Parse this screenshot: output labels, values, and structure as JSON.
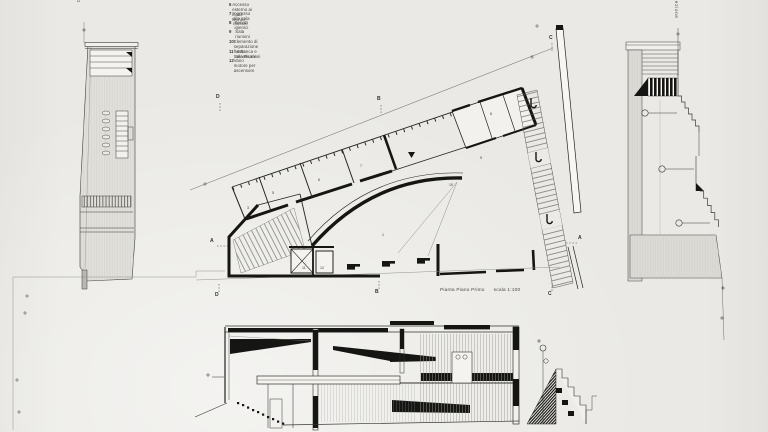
{
  "sheet": {
    "paper_color": "#e9e8e4",
    "ink_color": "#1d1d1b",
    "gray_fill": "#deddd8"
  },
  "legend": {
    "items": [
      {
        "num": "6",
        "text": "Accesso esterno ai locali tecnici"
      },
      {
        "num": "7",
        "text": "Ingresso alla sala riunioni"
      },
      {
        "num": "8",
        "text": "Servizi igienici"
      },
      {
        "num": "9",
        "text": "Sala riunioni"
      },
      {
        "num": "10",
        "text": "Elemento di separazione fra Banca e Sala Riunioni"
      },
      {
        "num": "11",
        "text": "Vano ascensore"
      },
      {
        "num": "12",
        "text": "Vano motore per ascensore"
      }
    ]
  },
  "plan": {
    "caption": "Pianta Piano Primo",
    "scale": "scala 1:100",
    "markers": {
      "a": "A",
      "b": "B",
      "c": "C",
      "d": "D"
    },
    "room_numbers": [
      "1",
      "3",
      "5",
      "6",
      "7",
      "8",
      "9",
      "10",
      "11",
      "12"
    ]
  },
  "left_section": {
    "title": "Sezione D-D"
  },
  "right_section": {
    "title": "Sezione"
  }
}
